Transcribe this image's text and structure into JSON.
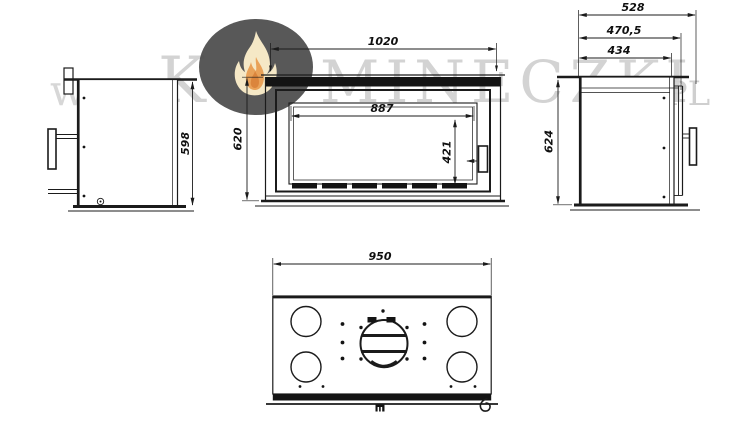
{
  "watermark": {
    "prefix": "www.",
    "letter": "K",
    "brand": "MINECZKI",
    "suffix": ".PL",
    "logo_icon": "flame-in-ellipse"
  },
  "dimensions": {
    "front_view": {
      "overall_width": "1020",
      "glass_width": "887",
      "overall_height": "620",
      "glass_height": "421"
    },
    "left_side_view": {
      "body_height": "598"
    },
    "right_side_view": {
      "overall_depth": "528",
      "depth_with_door": "470,5",
      "body_depth": "434",
      "overall_height": "624"
    },
    "top_view": {
      "overall_width": "950"
    }
  },
  "colors": {
    "line": "#1b1b1b",
    "watermark_text": "#d3d3d3",
    "logo_ellipse": "#4c4c4c",
    "flame_outer": "#f5e7c2",
    "flame_inner": "#e89b4d"
  }
}
